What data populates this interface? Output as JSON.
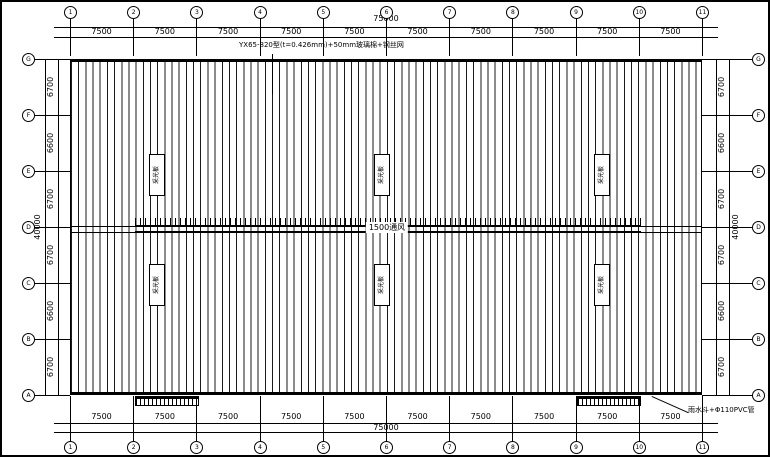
{
  "annotations": {
    "roof_spec": "YX65-820型(t=0.426mm)+50mm玻璃棉+钢丝网",
    "ridge_label": "1500通风",
    "downpipe_note": "雨水斗+Φ110PVC管",
    "skylight_label": "采光板"
  },
  "axes": {
    "top": [
      "1",
      "2",
      "3",
      "4",
      "5",
      "6",
      "7",
      "8",
      "9",
      "10",
      "11"
    ],
    "bottom": [
      "1",
      "2",
      "3",
      "4",
      "5",
      "6",
      "7",
      "8",
      "9",
      "10",
      "11"
    ],
    "left": [
      "G",
      "F",
      "E",
      "D",
      "C",
      "B",
      "A"
    ],
    "right": [
      "G",
      "F",
      "E",
      "D",
      "C",
      "B",
      "A"
    ]
  },
  "dimensions": {
    "top_bays": [
      "7500",
      "7500",
      "7500",
      "7500",
      "7500",
      "7500",
      "7500",
      "7500",
      "7500",
      "7500"
    ],
    "top_total": "75000",
    "bottom_bays": [
      "7500",
      "7500",
      "7500",
      "7500",
      "7500",
      "7500",
      "7500",
      "7500",
      "7500",
      "7500"
    ],
    "bottom_total": "75000",
    "left_segments": [
      "6700",
      "6600",
      "6700",
      "6700",
      "6600",
      "6700"
    ],
    "left_total": "40000",
    "right_segments": [
      "6700",
      "6600",
      "6700",
      "6700",
      "6600",
      "6700"
    ],
    "right_total": "40000"
  },
  "colors": {
    "line": "#000000",
    "background": "#ffffff"
  }
}
